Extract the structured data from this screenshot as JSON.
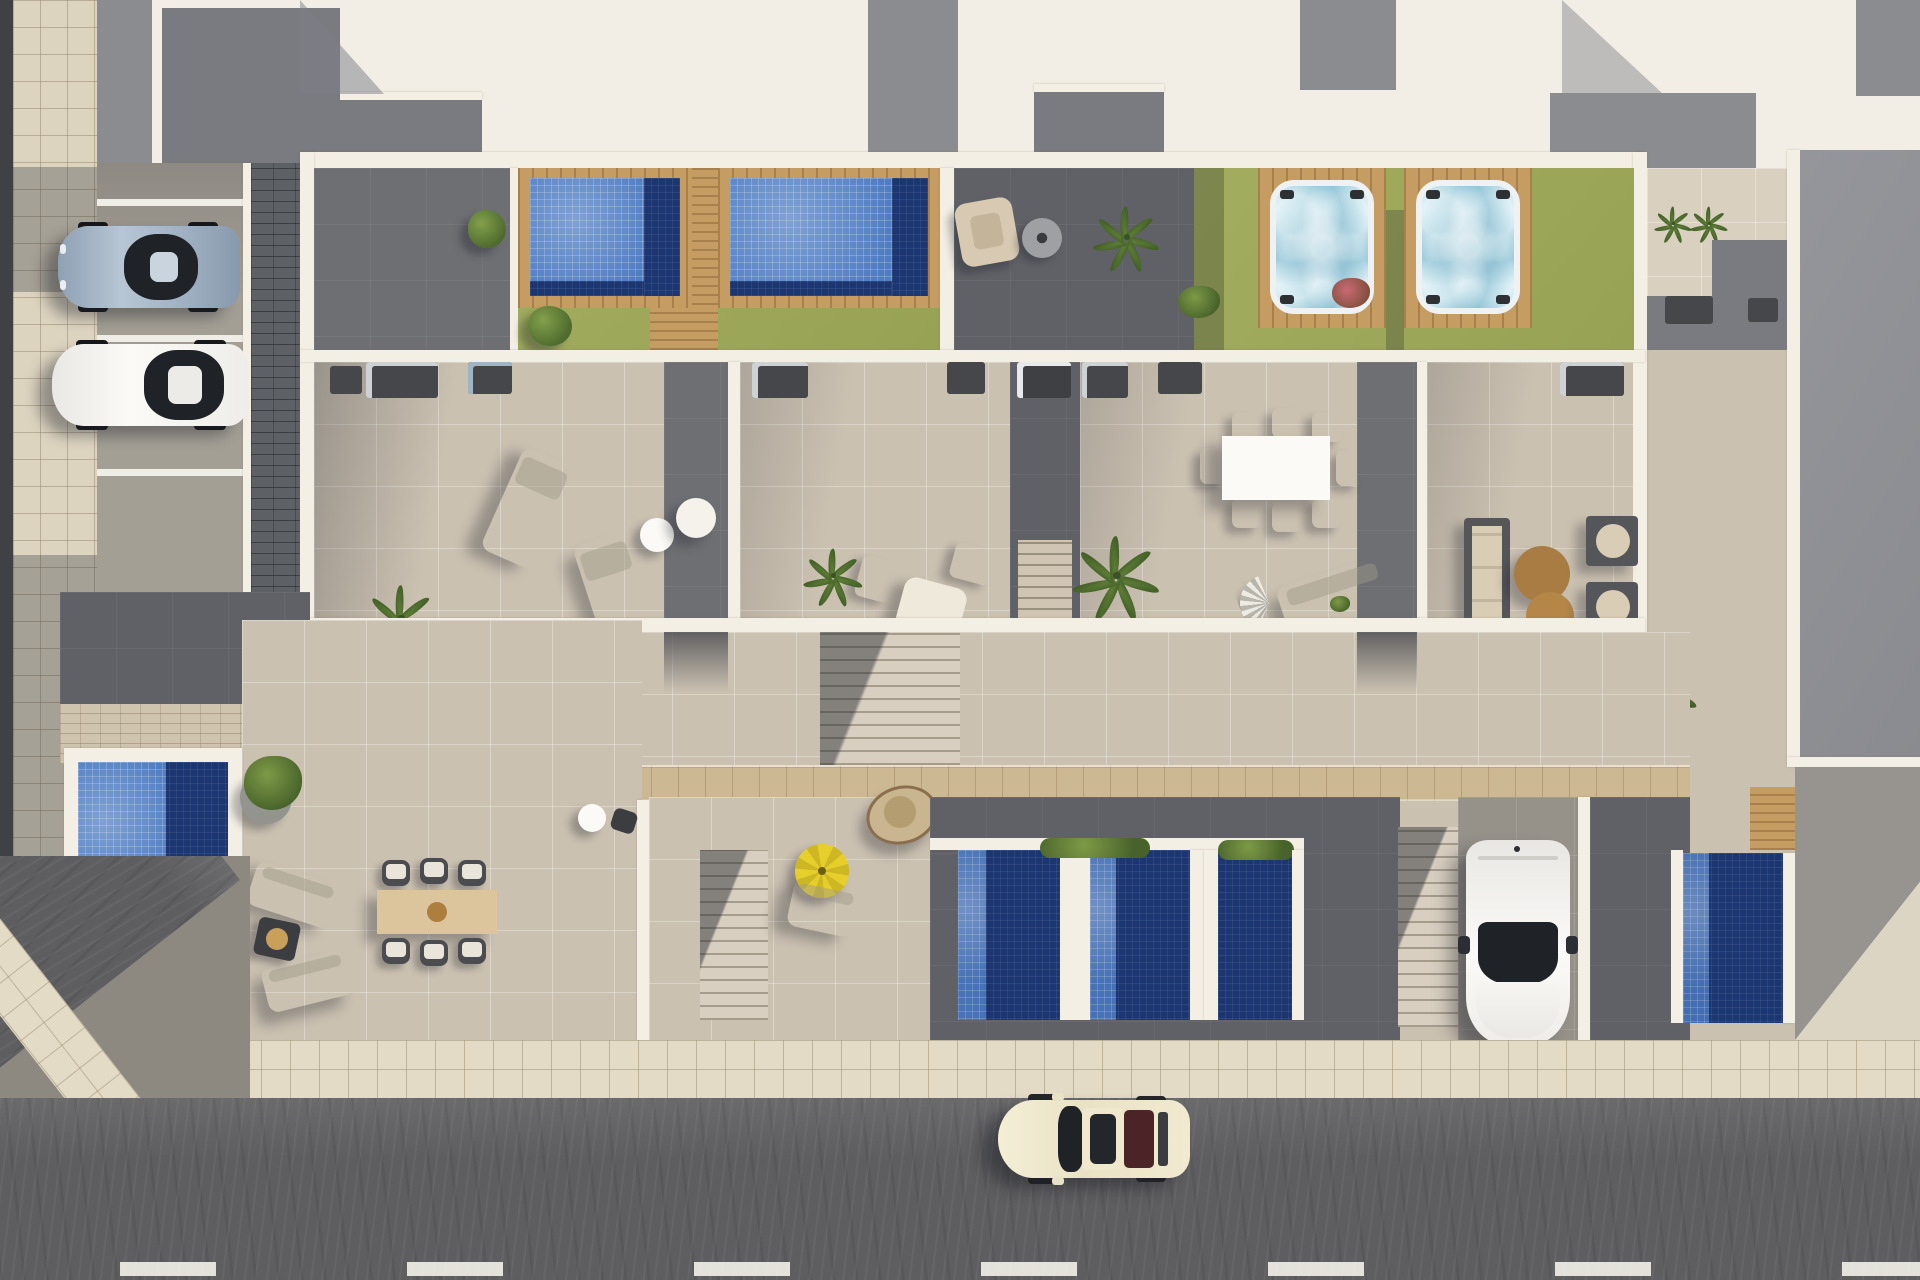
{
  "scene": {
    "type": "aerial-architectural-render",
    "description": "Top-down 3D render of a row of modern townhouses with roof terraces, two mosaic swimming pools, two jacuzzis on lawns, four plunge pools, outdoor furniture, a parking strip with two cars, a driveway with a white car, and a street with a cream car and dashed lane markings",
    "objects": [
      {
        "name": "white-roofs"
      },
      {
        "name": "gray-roof-terraces"
      },
      {
        "name": "mosaic-pool",
        "count": 2
      },
      {
        "name": "plunge-pool",
        "count": 4
      },
      {
        "name": "corner-pool",
        "count": 1
      },
      {
        "name": "jacuzzi",
        "count": 2
      },
      {
        "name": "lawn",
        "count": 2
      },
      {
        "name": "wood-deck",
        "count": 4
      },
      {
        "name": "sun-lounger",
        "count": 7
      },
      {
        "name": "dining-set",
        "count": 3
      },
      {
        "name": "sofa-set",
        "count": 1
      },
      {
        "name": "hanging-egg-chair",
        "count": 1
      },
      {
        "name": "yellow-parasol",
        "count": 1
      },
      {
        "name": "fan-parasol",
        "count": 1
      },
      {
        "name": "outdoor-kitchen",
        "count": 8
      },
      {
        "name": "palm-plant",
        "count": 9
      },
      {
        "name": "parked-car-silver",
        "count": 1
      },
      {
        "name": "parked-car-white",
        "count": 1
      },
      {
        "name": "driveway-car-white",
        "count": 1
      },
      {
        "name": "street-car-cream",
        "count": 1
      },
      {
        "name": "street-dashed-line",
        "count": 1
      },
      {
        "name": "tiled-sidewalk",
        "count": 1
      },
      {
        "name": "staircase",
        "count": 4
      }
    ]
  },
  "palette": {
    "wall": "#f4efe4",
    "roofWhite": "#f2eee5",
    "roofGray": "#8b8c90",
    "roofGrayDark": "#7a7b80",
    "patio": "#6e6f73",
    "patioDark": "#606167",
    "terrace": "#cbc1b1",
    "terraceLight": "#d9d0c0",
    "sidewalk": "#e4dbc6",
    "walkway": "#ddd4c0",
    "pavers": "#5d6166",
    "paversLight": "#cfc5ae",
    "lawn": "#a3ad60",
    "lawnShade": "#97a254",
    "wood": "#c59c62",
    "boardwalk": "#ccb994",
    "poolLight": "#4f7dc2",
    "poolDark": "#1c3672",
    "jacuzziWater": "#c5e6f0",
    "jacuzziRim": "#eef2f3",
    "driveway": "#96928a",
    "openGround": "#ddd5c3",
    "road": "#5e5e60",
    "lane": "#efeee6",
    "carCream": "#ece5c9",
    "carWhite": "#f3f2ef",
    "carSilver": "#9fb0c2",
    "glass": "#1f2227",
    "glassRear": "#4a2426",
    "umbrella": "#e6cf2b",
    "tableBrown": "#a87c42",
    "cushion": "#d9cdb6",
    "frame": "#55565a"
  }
}
